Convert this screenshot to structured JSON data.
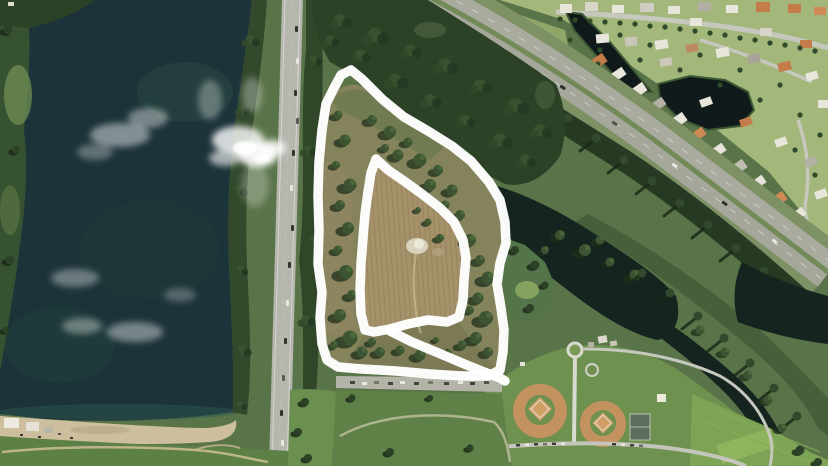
{
  "scene": {
    "type": "aerial-satellite-photo",
    "description": "Satellite view of a vacant scrub field parcel highlighted with a hand-drawn white marker outline (outer boundary, inner plowed area, and a connecting stroke), bordered by a lake, a vertical highway, a diagonal turnpike with a residential neighborhood and ponds, a dark wetland canal, and a community ballpark."
  },
  "annotation": {
    "color": "#ffffff",
    "stroke_width_px": 9.5,
    "opacity": 0.97,
    "outer_loop": [
      [
        334,
        88
      ],
      [
        341,
        75
      ],
      [
        351,
        70
      ],
      [
        362,
        79
      ],
      [
        382,
        99
      ],
      [
        404,
        117
      ],
      [
        428,
        131
      ],
      [
        452,
        146
      ],
      [
        471,
        161
      ],
      [
        489,
        182
      ],
      [
        500,
        200
      ],
      [
        505,
        222
      ],
      [
        506,
        243
      ],
      [
        500,
        263
      ],
      [
        497,
        284
      ],
      [
        501,
        308
      ],
      [
        504,
        330
      ],
      [
        503,
        352
      ],
      [
        500,
        370
      ],
      [
        488,
        376
      ],
      [
        462,
        376
      ],
      [
        430,
        374
      ],
      [
        396,
        371
      ],
      [
        362,
        369
      ],
      [
        338,
        367
      ],
      [
        327,
        360
      ],
      [
        322,
        344
      ],
      [
        320,
        318
      ],
      [
        322,
        292
      ],
      [
        318,
        264
      ],
      [
        319,
        230
      ],
      [
        318,
        196
      ],
      [
        319,
        162
      ],
      [
        322,
        130
      ],
      [
        326,
        104
      ]
    ],
    "inner_loop": [
      [
        376,
        159
      ],
      [
        388,
        170
      ],
      [
        404,
        181
      ],
      [
        422,
        194
      ],
      [
        440,
        208
      ],
      [
        454,
        222
      ],
      [
        463,
        240
      ],
      [
        466,
        258
      ],
      [
        464,
        280
      ],
      [
        463,
        300
      ],
      [
        459,
        317
      ],
      [
        447,
        322
      ],
      [
        428,
        320
      ],
      [
        408,
        324
      ],
      [
        390,
        329
      ],
      [
        374,
        332
      ],
      [
        365,
        330
      ],
      [
        361,
        314
      ],
      [
        360,
        290
      ],
      [
        361,
        264
      ],
      [
        363,
        238
      ],
      [
        365,
        214
      ],
      [
        368,
        192
      ],
      [
        371,
        173
      ]
    ],
    "connector": [
      [
        390,
        331
      ],
      [
        412,
        342
      ],
      [
        436,
        352
      ],
      [
        462,
        363
      ],
      [
        484,
        372
      ],
      [
        500,
        378
      ],
      [
        505,
        381
      ]
    ]
  },
  "palette": {
    "lake_water": "#1c333a",
    "pond_water": "#101a1b",
    "wetland_water": "#16241f",
    "plowed_field": "#a5916a",
    "field_scrub": "#85835c",
    "forest": "#2c4226",
    "neighborhood_lawn": "#a3b77b",
    "park_grass": "#6e9150",
    "highway_asphalt": "#b5b6ae",
    "turnpike_asphalt": "#a9ab9f",
    "sand_shore": "#cdbf9e",
    "baseball_infield": "#c3925f",
    "cloud": "#ffffff"
  }
}
